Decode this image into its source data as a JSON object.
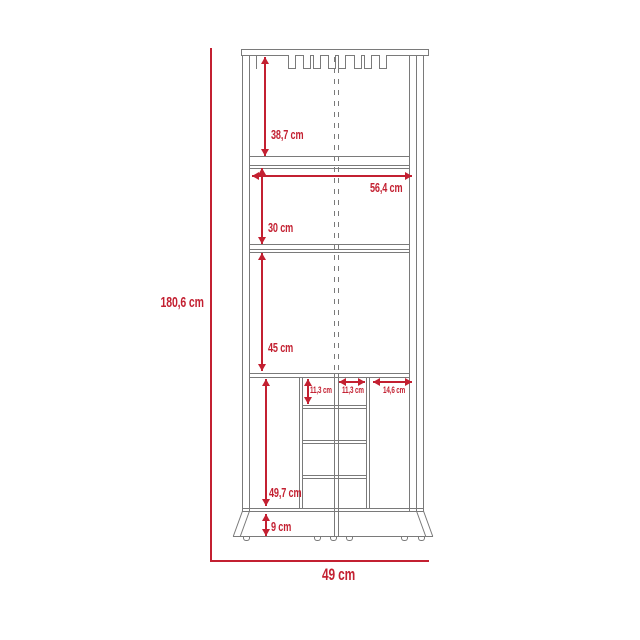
{
  "colors": {
    "dimension": "#c32031",
    "outline": "#7a7a7a",
    "background": "#ffffff"
  },
  "diagram": {
    "unit": "cm",
    "dimensions": {
      "overall_height": "180,6 cm",
      "overall_width": "49 cm",
      "top_section_height": "38,7 cm",
      "interior_width": "56,4 cm",
      "middle_section_height": "30 cm",
      "lower_section_height": "45 cm",
      "bottle_rack_row_height": "11,3 cm",
      "bottle_rack_center_width": "11,3 cm",
      "bottle_rack_side_width": "14,6 cm",
      "bottom_section_height": "49,7 cm",
      "base_height": "9 cm"
    }
  }
}
